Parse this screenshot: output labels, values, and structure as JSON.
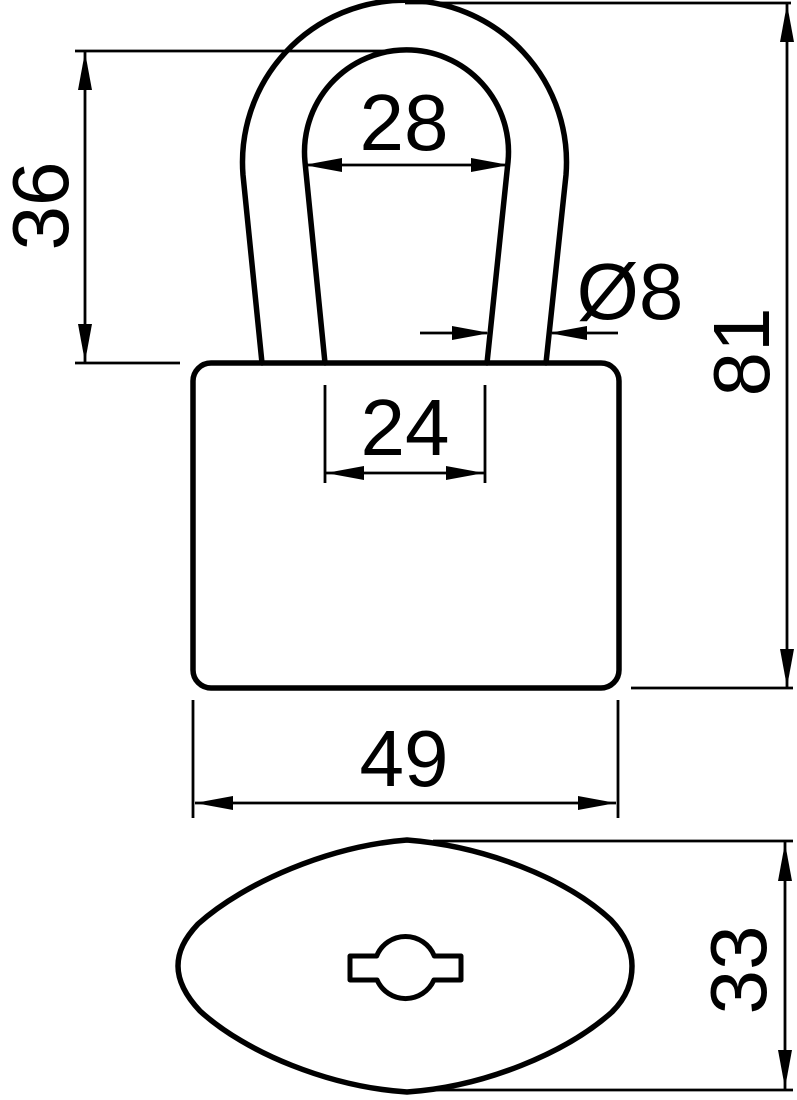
{
  "page": {
    "background": "#ffffff",
    "stroke_color": "#000000",
    "type": "technical dimension drawing",
    "subject": "padlock"
  },
  "views": {
    "front_view": "padlock front elevation with U-shaped shackle and rounded body",
    "top_view": "padlock top profile (lens shape) with keyhole slot"
  },
  "dimensions": {
    "shackle_inner_width": "28",
    "shackle_height": "36",
    "shackle_diameter": "Ø8",
    "overall_height": "81",
    "shackle_leg_spacing": "24",
    "body_width": "49",
    "body_depth": "33"
  }
}
